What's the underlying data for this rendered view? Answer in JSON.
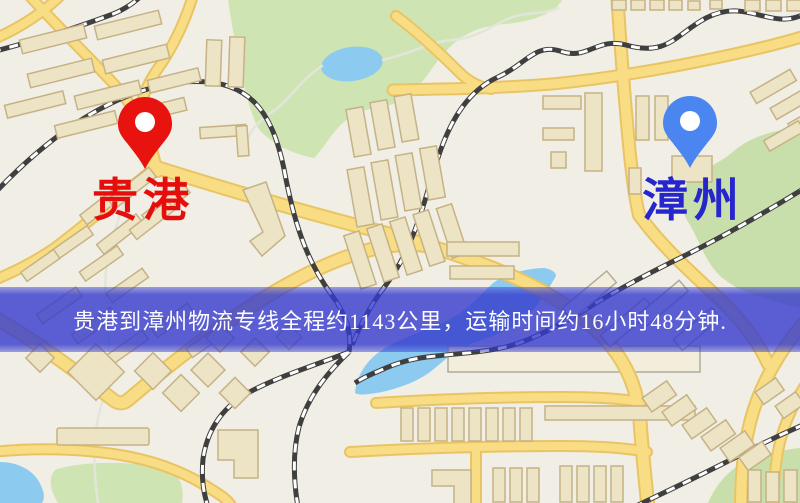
{
  "map": {
    "origin": {
      "name": "贵港",
      "pin_color": "#e8120e",
      "label_color": "#e60d0d"
    },
    "destination": {
      "name": "漳州",
      "pin_color": "#4b86f0",
      "label_color": "#2526cb"
    },
    "banner": {
      "text": "贵港到漳州物流专线全程约1143公里，运输时间约16小时48分钟.",
      "background": "#343acd",
      "text_color": "#fdfdfd"
    },
    "route": {
      "distance_km": "1143",
      "duration": "16小时48分钟"
    }
  }
}
